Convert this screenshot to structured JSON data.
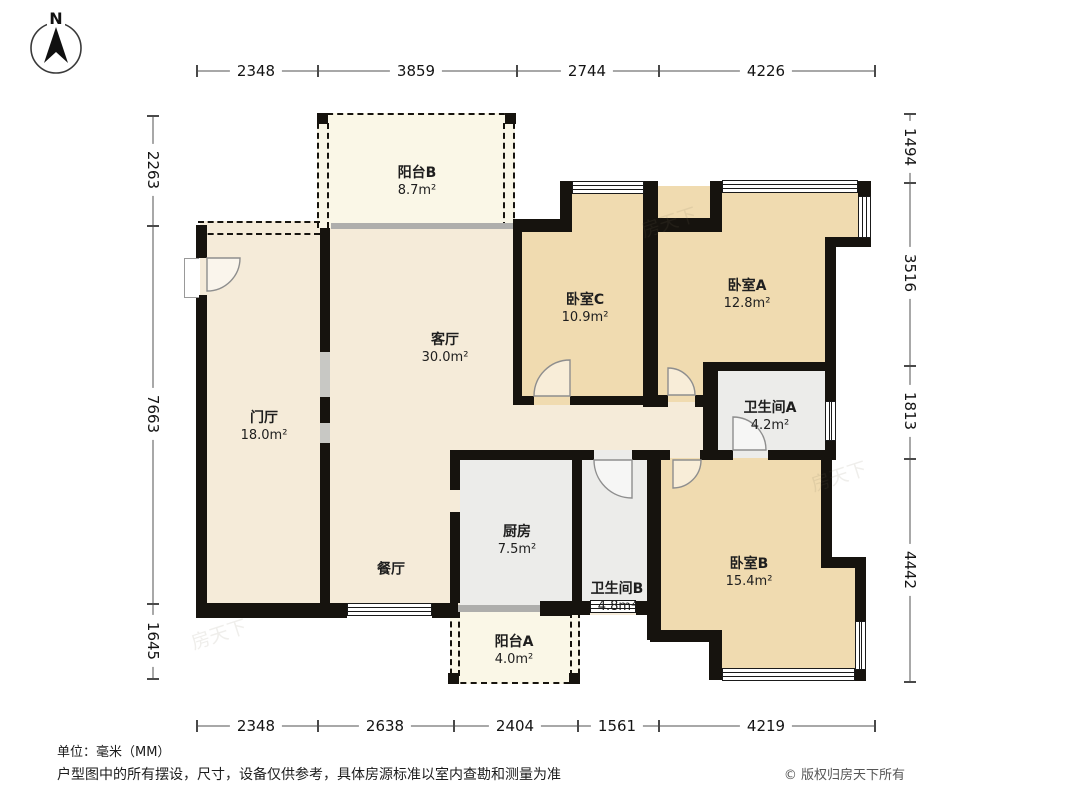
{
  "compass": {
    "label": "N"
  },
  "rooms": [
    {
      "id": "balcony-b",
      "name": "阳台B",
      "area": "8.7m²"
    },
    {
      "id": "bedroom-c",
      "name": "卧室C",
      "area": "10.9m²"
    },
    {
      "id": "bedroom-a",
      "name": "卧室A",
      "area": "12.8m²"
    },
    {
      "id": "living-room",
      "name": "客厅",
      "area": "30.0m²"
    },
    {
      "id": "foyer",
      "name": "门厅",
      "area": "18.0m²"
    },
    {
      "id": "bathroom-a",
      "name": "卫生间A",
      "area": "4.2m²"
    },
    {
      "id": "kitchen",
      "name": "厨房",
      "area": "7.5m²"
    },
    {
      "id": "dining-room",
      "name": "餐厅",
      "area": ""
    },
    {
      "id": "bathroom-b",
      "name": "卫生间B",
      "area": "4.8m²"
    },
    {
      "id": "bedroom-b",
      "name": "卧室B",
      "area": "15.4m²"
    },
    {
      "id": "balcony-a",
      "name": "阳台A",
      "area": "4.0m²"
    }
  ],
  "dimensions": {
    "top": [
      "2348",
      "3859",
      "2744",
      "4226"
    ],
    "bottom": [
      "2348",
      "2638",
      "2404",
      "1561",
      "4219"
    ],
    "left": [
      "2263",
      "7663",
      "1645"
    ],
    "right": [
      "1494",
      "3516",
      "1813",
      "4442"
    ]
  },
  "footer": {
    "unit_note": "单位：毫米（MM）",
    "disclaimer": "户型图中的所有摆设，尺寸，设备仅供参考，具体房源标准以室内查勘和测量为准",
    "copyright": "© 版权归房天下所有"
  },
  "watermark": "房天下",
  "colors": {
    "hall_fill": "#f5ebd9",
    "bedroom_fill": "#f0dbb0",
    "wet_fill": "#ececea",
    "balcony_fill": "#faf7e7",
    "wall": "#16130e"
  }
}
